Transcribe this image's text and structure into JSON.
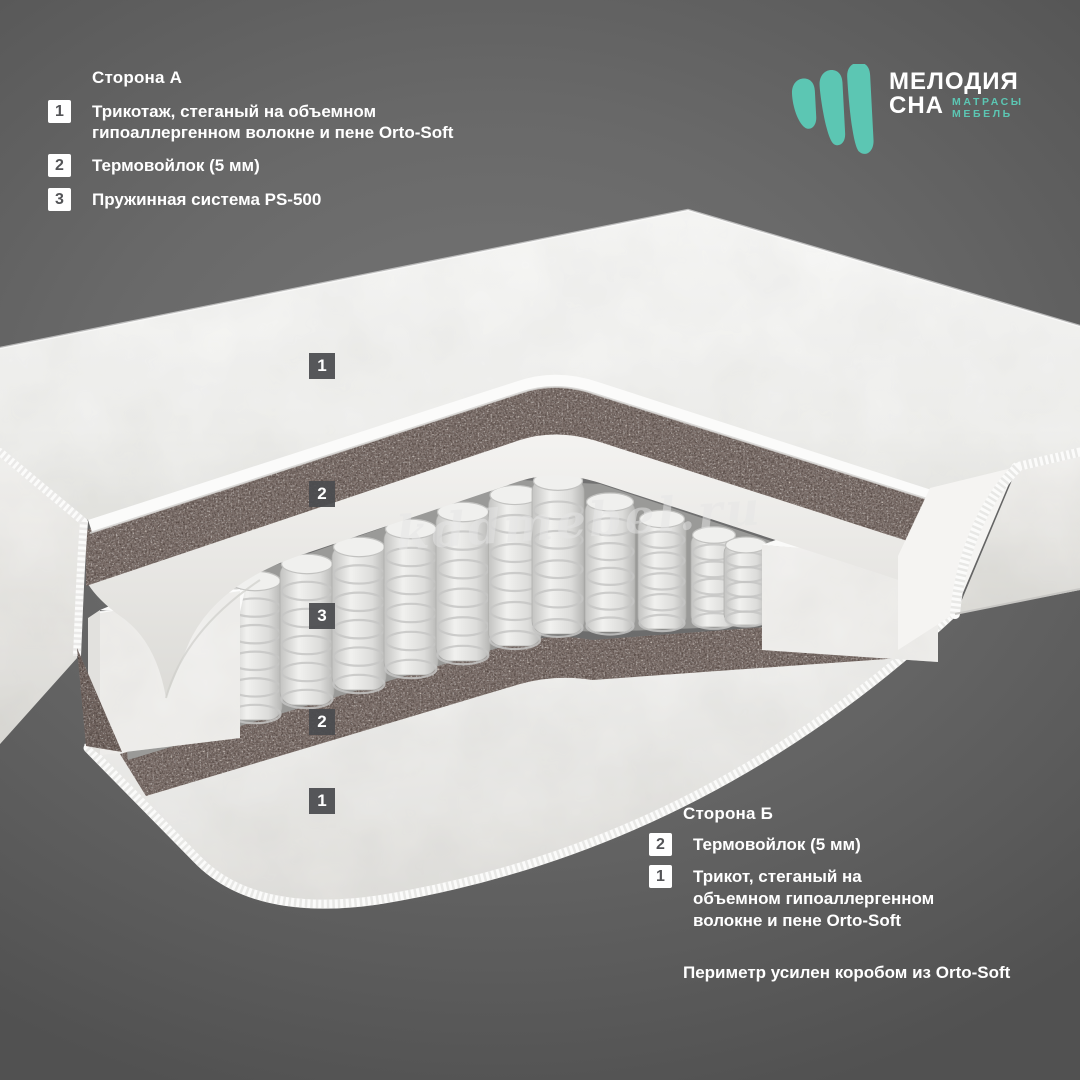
{
  "logo": {
    "brand_top": "МЕЛОДИЯ",
    "brand_bottom": "СНА",
    "tagline_top": "МАТРАСЫ",
    "tagline_bottom": "МЕБЕЛЬ",
    "accent_color": "#5CC6B3"
  },
  "side_a": {
    "title": "Сторона А",
    "items": [
      {
        "num": "1",
        "text": "Трикотаж, стеганый на объемном гипоаллергенном волокне и пене Orto-Soft"
      },
      {
        "num": "2",
        "text": "Термовойлок (5 мм)"
      },
      {
        "num": "3",
        "text": "Пружинная система PS-500"
      }
    ]
  },
  "side_b": {
    "title": "Сторона Б",
    "items": [
      {
        "num": "2",
        "text": "Термовойлок (5 мм)"
      },
      {
        "num": "1",
        "text": "Трикот, стеганый на объемном гипоаллергенном волокне и пене Orto-Soft"
      }
    ]
  },
  "perimeter_note": "Периметр усилен коробом из Orto-Soft",
  "watermark": "kddmebel.ru",
  "markers": [
    {
      "num": "1"
    },
    {
      "num": "2"
    },
    {
      "num": "3"
    },
    {
      "num": "2"
    },
    {
      "num": "1"
    }
  ],
  "colors": {
    "felt": "#887b76",
    "marker_bg": "#4a4b4f",
    "background": "#696969"
  }
}
